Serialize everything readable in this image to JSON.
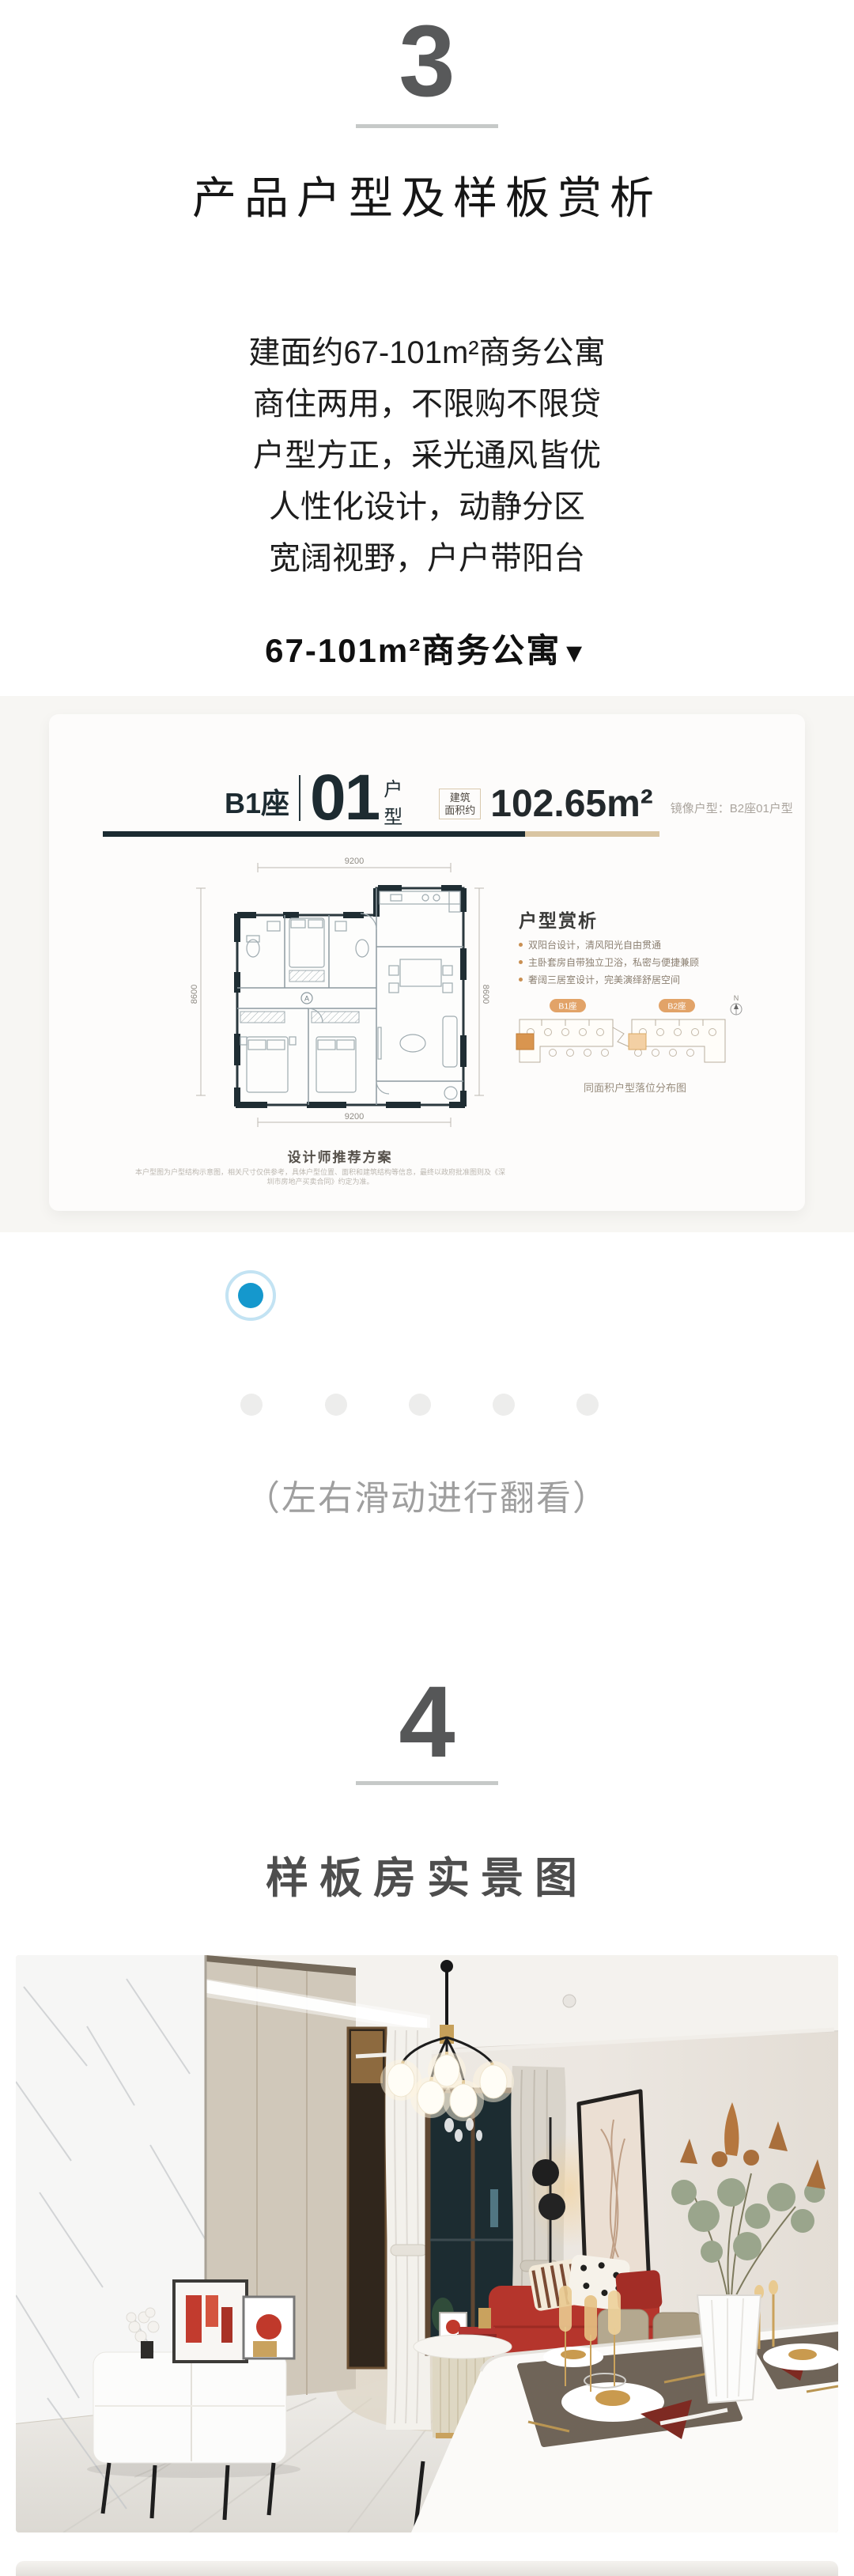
{
  "section3": {
    "number": "3",
    "title": "产品户型及样板赏析",
    "paragraph_lines": [
      "建面约67-101m²商务公寓",
      "商住两用，不限购不限贷",
      "户型方正，采光通风皆优",
      "人性化设计，动静分区",
      "宽阔视野，户户带阳台"
    ],
    "subtitle": "67-101m²商务公寓",
    "subtitle_arrow": "▼"
  },
  "floorplan_card": {
    "block": "B1座",
    "unit_number": "01",
    "unit_label_top": "户",
    "unit_label_bottom": "型",
    "area_badge_line1": "建筑",
    "area_badge_line2": "面积约",
    "area_value": "102.65m²",
    "mirror_note": "镜像户型：B2座01户型",
    "plan": {
      "dim_top": "9200",
      "dim_bottom": "9200",
      "dim_left": "8600",
      "dim_right": "8600",
      "ac_label": "A"
    },
    "analysis": {
      "heading": "户型赏析",
      "bullets": [
        "双阳台设计，清风阳光自由贯通",
        "主卧套房自带独立卫浴，私密与便捷兼顾",
        "奢阔三居室设计，完美演绎舒居空间"
      ]
    },
    "location": {
      "badge_left": "B1座",
      "badge_right": "B2座",
      "compass": "N",
      "caption": "同面积户型落位分布图"
    },
    "recommend_caption": "设计师推荐方案",
    "disclaimer": "本户型图为户型结构示意图，相关尺寸仅供参考，具体户型位置、面积和建筑结构等信息，最终以政府批准图则及《深圳市房地产买卖合同》约定为准。"
  },
  "carousel": {
    "hint": "（左右滑动进行翻看）",
    "slide_count": 5,
    "active_slide": 1
  },
  "section4": {
    "number": "4",
    "title": "样板房实景图"
  },
  "colors": {
    "accent_blue": "#1598cd",
    "divider_dark": "#1b2b31",
    "divider_beige": "#d9c5a2",
    "badge_orange": "#e2a368",
    "underline_gray": "#c6c9c8"
  }
}
